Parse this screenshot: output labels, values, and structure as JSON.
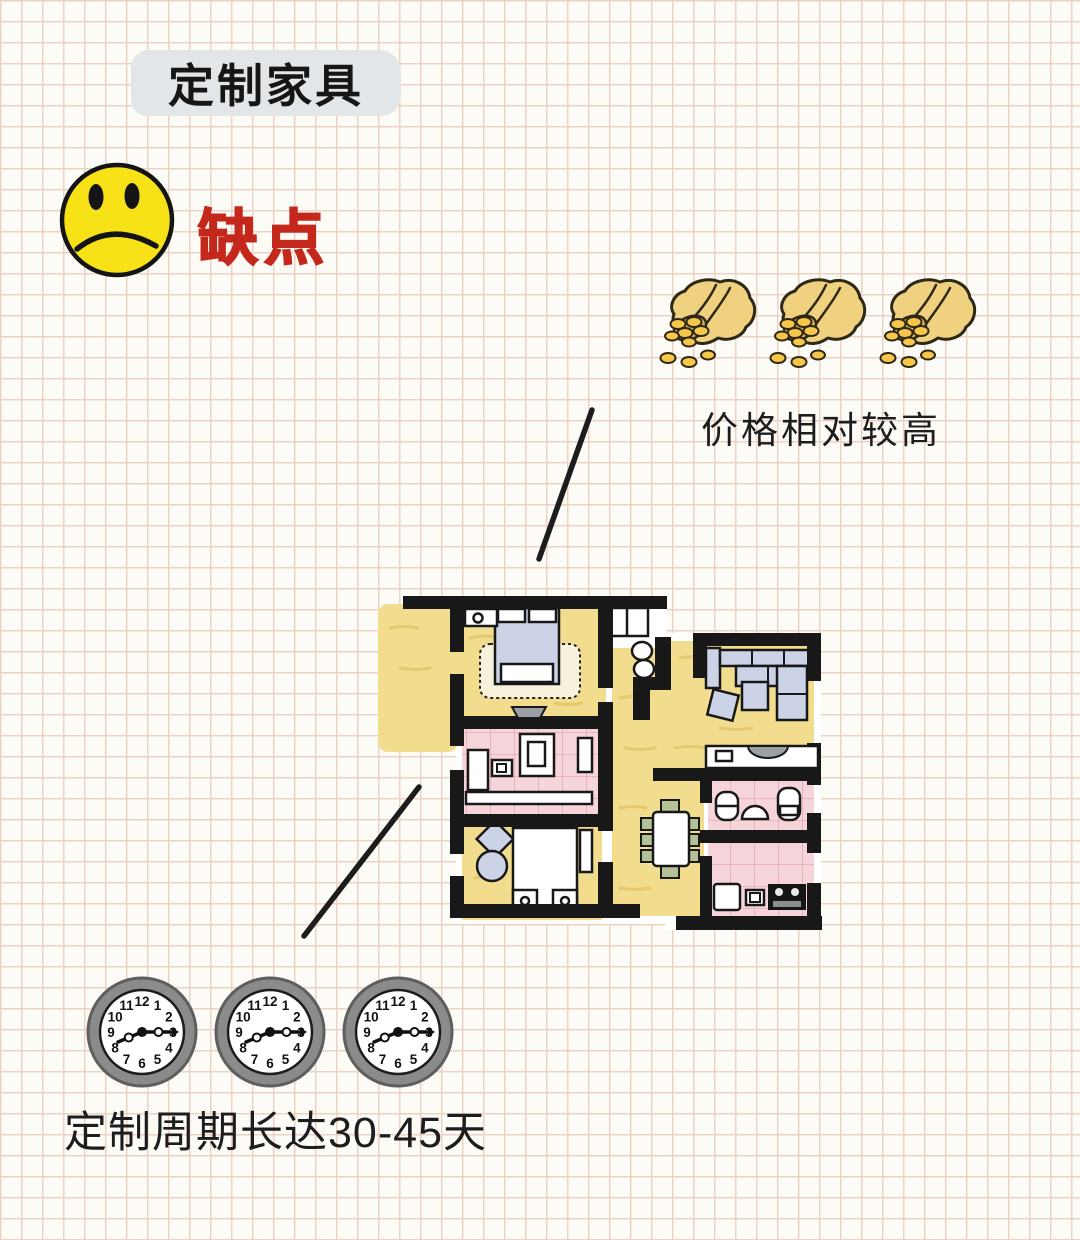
{
  "colors": {
    "paper": "#fdfbf6",
    "grid_line": "#ead3c4",
    "highlight": "#e2e6e9",
    "accent_red": "#c4271b",
    "face_yellow": "#f6e216",
    "wall": "#181818",
    "floor_yellow": "#f2dc8d",
    "floor_pink": "#f5d5da",
    "tile_line": "#e8a8b4",
    "floor_texture": "#e2c167",
    "furniture_blue": "#ccd3e7",
    "chair_green": "#b5c197",
    "sink_gray": "#9aa0a4",
    "bag_tan": "#efd180",
    "bag_shadow": "#d8b562",
    "coin_gold": "#f6c74a",
    "clock_rim": "#8b8b8b"
  },
  "title": {
    "text": "定制家具"
  },
  "verdict": {
    "label": "缺点",
    "emoji": "sad-face"
  },
  "price": {
    "caption": "价格相对较高",
    "money_bag_count": 3
  },
  "duration": {
    "caption": "定制周期长达30-45天",
    "clock_count": 3,
    "clock_time": "8:15",
    "clock_numerals": [
      "12",
      "1",
      "2",
      "3",
      "4",
      "5",
      "6",
      "7",
      "8",
      "9",
      "10",
      "11"
    ]
  }
}
